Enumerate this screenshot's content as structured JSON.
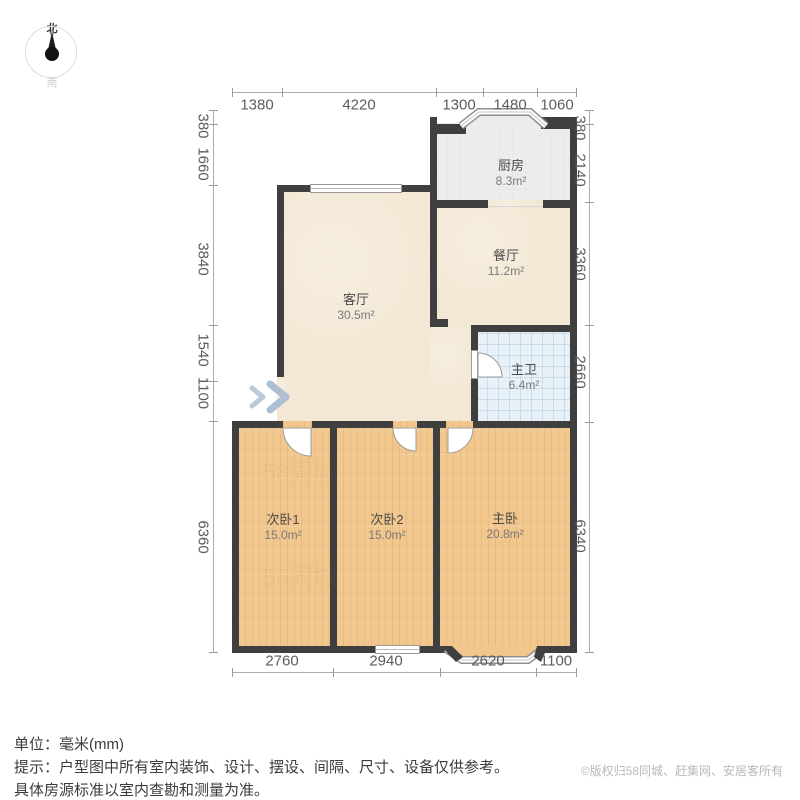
{
  "compass": {
    "north": "北",
    "south": "南"
  },
  "dimensions": {
    "top": [
      "1380",
      "4220",
      "1300",
      "1480",
      "1060"
    ],
    "left": [
      "380",
      "1660",
      "3840",
      "1540",
      "1100",
      "6360"
    ],
    "right": [
      "380",
      "2140",
      "3360",
      "2660",
      "6340"
    ],
    "bottom": [
      "2760",
      "2940",
      "2620",
      "1100"
    ]
  },
  "rooms": {
    "kitchen": {
      "name": "厨房",
      "area": "8.3m²"
    },
    "dining": {
      "name": "餐厅",
      "area": "11.2m²"
    },
    "living": {
      "name": "客厅",
      "area": "30.5m²"
    },
    "master_bath": {
      "name": "主卫",
      "area": "6.4m²"
    },
    "bedroom1": {
      "name": "次卧1",
      "area": "15.0m²"
    },
    "bedroom2": {
      "name": "次卧2",
      "area": "15.0m²"
    },
    "master_bedroom": {
      "name": "主卧",
      "area": "20.8m²"
    }
  },
  "footer": {
    "unit_line": "单位：毫米(mm)",
    "tip_line1": "提示：户型图中所有室内装饰、设计、摆设、间隔、尺寸、设备仅供参考。",
    "tip_line2": "具体房源标准以室内查勘和测量为准。",
    "copyright": "©版权归58同城、赶集网、安居客所有"
  },
  "watermark": "58同城",
  "colors": {
    "wall": "#3f3f3f",
    "floor_living": "#f3e8d5",
    "floor_wood": "#f2c78d",
    "floor_kitchen": "#ececea",
    "floor_bath": "#e7f1f7",
    "entry_arrow": "#b3c2d6",
    "dim_text": "#5c5c5c"
  }
}
